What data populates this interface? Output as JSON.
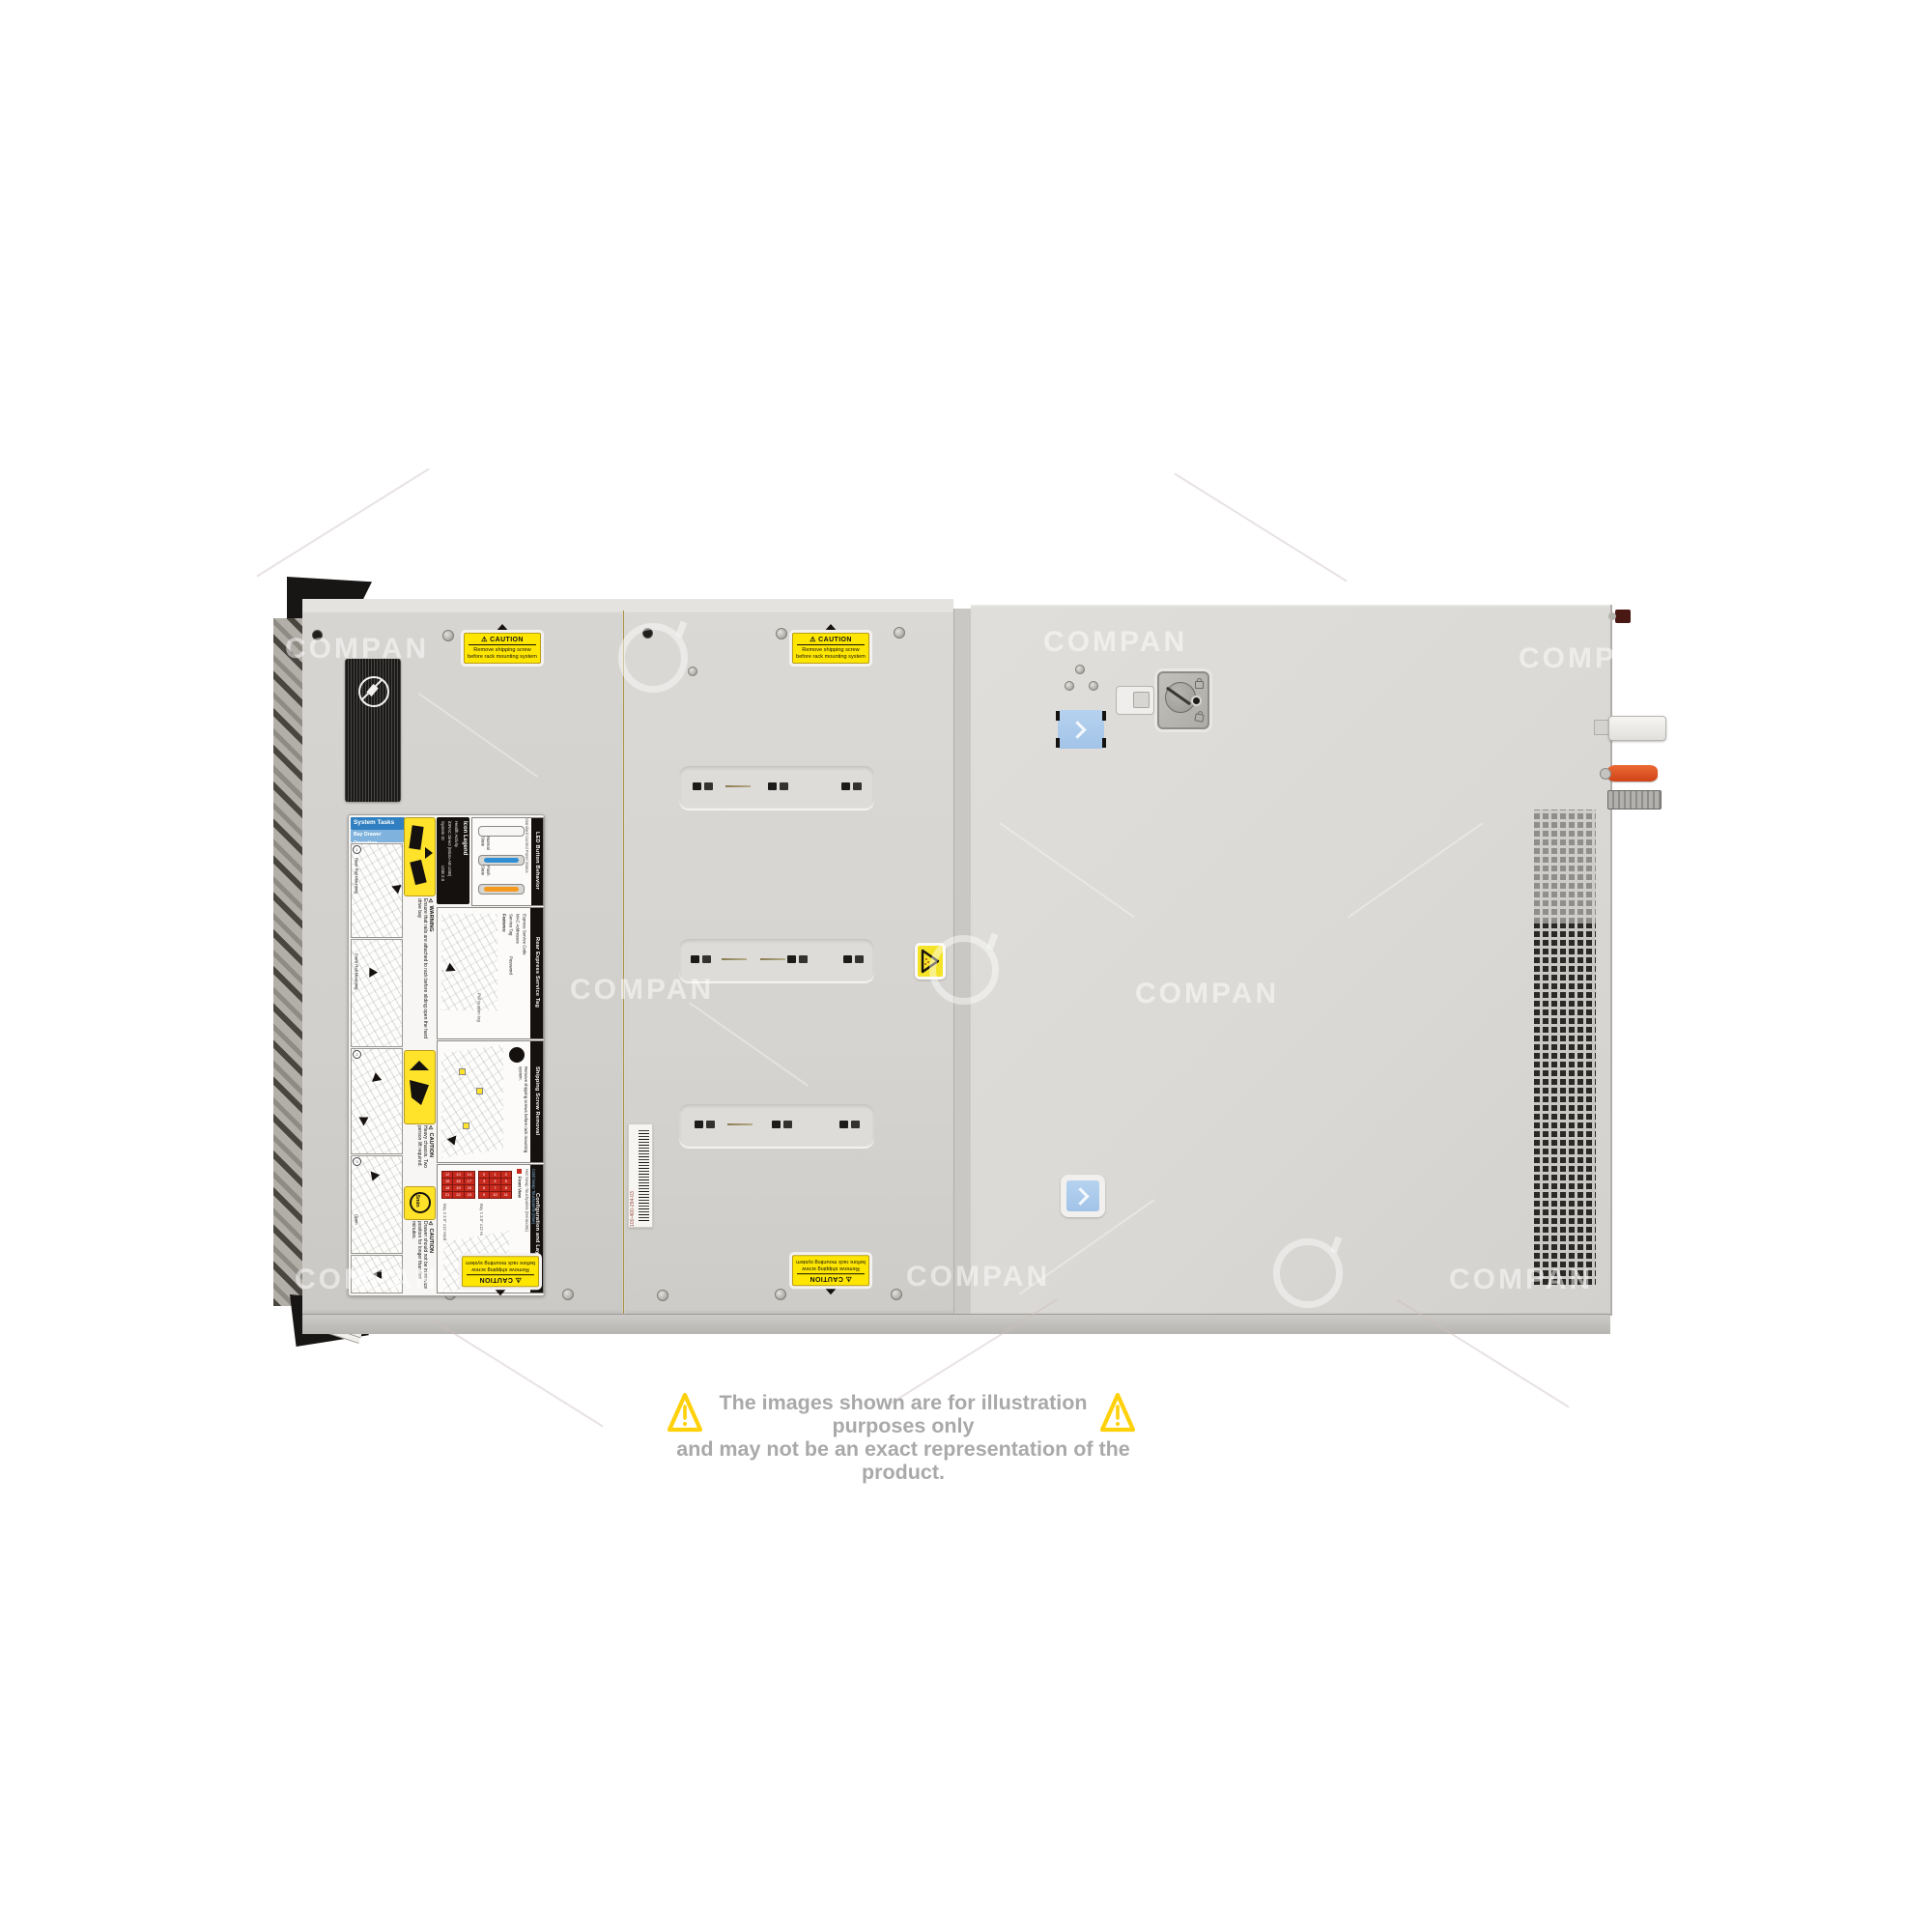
{
  "page": {
    "disclaimer": {
      "line1": "The images shown are for illustration purposes only",
      "line2": "and may not be an exact representation of the product."
    },
    "watermark": {
      "text": "COMPAN"
    }
  },
  "colors": {
    "caution_yellow": "#FFE600",
    "triangle_yellow": "#FFD10A",
    "disclaimer_gray": "#A9A9A9",
    "chassis_gray": "#D8D6D2",
    "button_blue": "#A9C9E8",
    "lever_orange": "#E0502A",
    "drive_grid_red": "#C8291D",
    "header_blue": "#2F7FC1"
  },
  "server": {
    "caution_sticker": {
      "title": "⚠ CAUTION",
      "line1": "Remove shipping screw",
      "line2": "before rack mounting system"
    },
    "barcode_label": {
      "text": "100-400-294-03"
    },
    "service_label": {
      "system_tasks": {
        "title": "System Tasks",
        "subtitle": "Bay Drawer Operation",
        "steps": [
          "Rear Rail Mounting",
          "Front Rail Mounting",
          "Open"
        ]
      },
      "icon_legend": {
        "title": "Icon Legend",
        "items": [
          "System ID",
          "iDRAC Direct (Micro-AB USB)",
          "Health Activity",
          "USB 2.0"
        ]
      },
      "led_button": {
        "title": "LED Button Behavior",
        "subtitle": "Standard Control Panel Status",
        "state1": "Normal State",
        "state2": "Flash State"
      },
      "rear_tag": {
        "title": "Rear Express Service Tag",
        "features_label": "Features:",
        "features": [
          "Service Tag",
          "Password",
          "MAC Addresses",
          "Express Service Code"
        ],
        "note": "Pull to open tag"
      },
      "shipping": {
        "title": "Shipping Screw Removal",
        "text": "Remove shipping screws before rack mounting system."
      },
      "config": {
        "title": "Configuration and Layout",
        "front_view": "Front View",
        "bay2": "Bay 2  3.5\" x12 Hard Drives",
        "bay1": "Bay 1  3.5\" x12 Hard Drives",
        "bay2_numbers": [
          12,
          13,
          14,
          15,
          16,
          17,
          18,
          19,
          20,
          21,
          22,
          23
        ],
        "bay1_numbers": [
          0,
          1,
          2,
          3,
          4,
          5,
          6,
          7,
          8,
          9,
          10,
          11
        ],
        "legend_hot": "Hot Swap Touchpoints (terracotta)",
        "legend_cold": "Cold Swap Touchpoints (blue)"
      },
      "warning_rails": {
        "label": "⚠ WARNING",
        "text": "Ensure that rails are attached to rack before sliding open the hard drive bay"
      },
      "caution_lift": {
        "label": "⚠ CAUTION",
        "text": "Heavy chassis. Two person lift required."
      },
      "caution_drawer": {
        "label": "⚠ CAUTION",
        "badge": "5min",
        "text": "Drawer should not be in service position for longer than five minutes."
      }
    }
  }
}
